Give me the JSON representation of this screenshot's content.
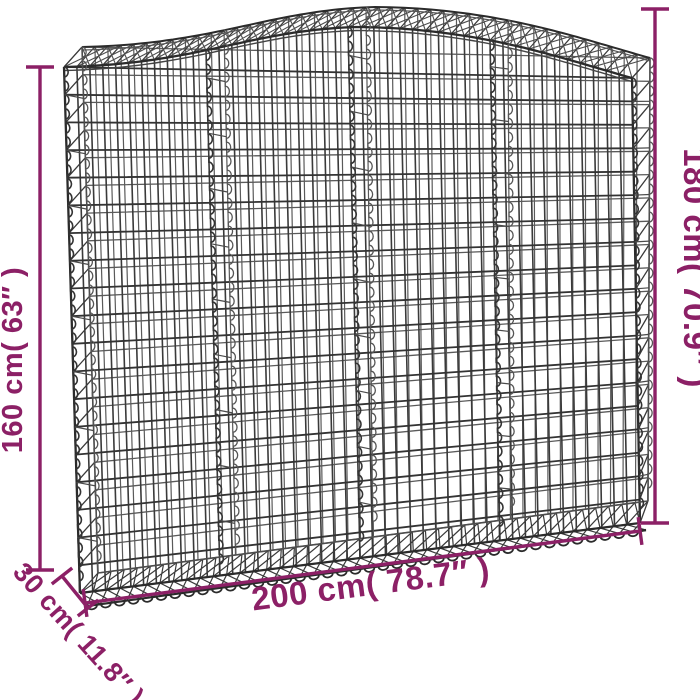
{
  "figure": {
    "subject": "arched-gabion-wire-basket",
    "view": "three-quarter perspective wireframe product drawing"
  },
  "colors": {
    "background": "#ffffff",
    "accent": "#8c2066",
    "wire": "#3a3a3a",
    "wire_light": "#5a5a5a",
    "wire_dark": "#2b2b2b"
  },
  "dimensions": {
    "height_left": {
      "label": "160 cm( 63″ )",
      "value_cm": 160,
      "value_in": "63″"
    },
    "height_right": {
      "label": "180 cm( 70.9″ )",
      "value_cm": 180,
      "value_in": "70.9″"
    },
    "width_bottom": {
      "label": "200 cm( 78.7″ )",
      "value_cm": 200,
      "value_in": "78.7″"
    },
    "depth": {
      "label": "30 cm( 11.8″ )",
      "value_cm": 30,
      "value_in": "11.8″"
    }
  }
}
